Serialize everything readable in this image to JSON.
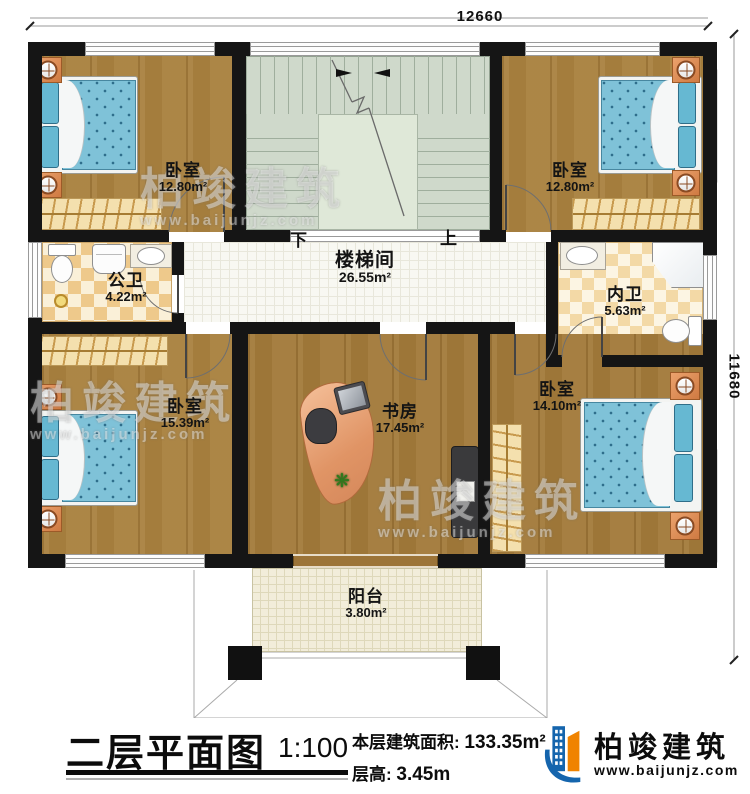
{
  "dimensions": {
    "top": "12660",
    "right": "11680"
  },
  "rooms": {
    "bedroom_tl": {
      "name": "卧室",
      "area": "12.80m²"
    },
    "bedroom_tr": {
      "name": "卧室",
      "area": "12.80m²"
    },
    "bath_public": {
      "name": "公卫",
      "area": "4.22m²"
    },
    "stair_hall": {
      "name": "楼梯间",
      "area": "26.55m²"
    },
    "bath_private": {
      "name": "内卫",
      "area": "5.63m²"
    },
    "bedroom_bl": {
      "name": "卧室",
      "area": "15.39m²"
    },
    "study": {
      "name": "书房",
      "area": "17.45m²"
    },
    "bedroom_br": {
      "name": "卧室",
      "area": "14.10m²"
    },
    "balcony": {
      "name": "阳台",
      "area": "3.80m²"
    }
  },
  "stairs": {
    "down_label": "下",
    "up_label": "上"
  },
  "titleblock": {
    "title": "二层平面图",
    "scale": "1:100",
    "area_label": "本层建筑面积: ",
    "area_value": "133.35m²",
    "floor_height_label": "层高: ",
    "floor_height_value": "3.45m"
  },
  "brand": {
    "name": "柏竣建筑",
    "website": "www.baijunjz.com"
  },
  "watermark": {
    "name": "柏竣建筑",
    "website": "www.baijunjz.com"
  },
  "plant_glyph": "❋",
  "colors": {
    "wall": "#151515",
    "accent_blue": "#1565ad",
    "accent_orange": "#f08300"
  }
}
